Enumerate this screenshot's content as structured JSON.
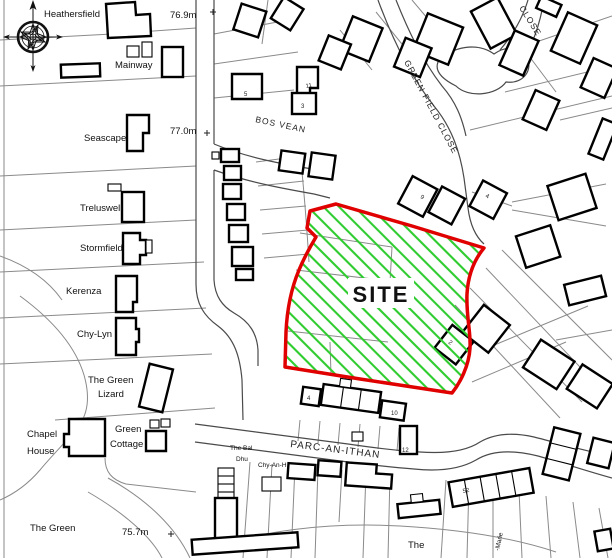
{
  "site": {
    "label": "SITE",
    "boundary_color": "#e00000",
    "hatch_color": "#2ecc2e"
  },
  "place_labels": [
    {
      "text": "Heathersfield"
    },
    {
      "text": "Mainway"
    },
    {
      "text": "Seascape"
    },
    {
      "text": "Treluswell"
    },
    {
      "text": "Stormfield"
    },
    {
      "text": "Kerenza"
    },
    {
      "text": "Chy-Lyn"
    },
    {
      "text": "The Green"
    },
    {
      "text": "Lizard"
    },
    {
      "text": "Chapel"
    },
    {
      "text": "House"
    },
    {
      "text": "Green"
    },
    {
      "text": "Cottage"
    },
    {
      "text": "The Green"
    },
    {
      "text": "The"
    },
    {
      "text": "The Bal"
    },
    {
      "text": "Dhu"
    },
    {
      "text": "Chy-An-H"
    },
    {
      "text": "-Marie"
    }
  ],
  "road_labels": [
    {
      "text": "BOS VEAN"
    },
    {
      "text": "GREEN FIELD CLOSE"
    },
    {
      "text": "CLOSE"
    },
    {
      "text": "PARC-AN-ITHAN"
    }
  ],
  "spot_heights": [
    {
      "text": "76.9m"
    },
    {
      "text": "77.0m"
    },
    {
      "text": "75.7m"
    }
  ],
  "house_numbers": [
    {
      "text": "5"
    },
    {
      "text": "11"
    },
    {
      "text": "3"
    },
    {
      "text": "9"
    },
    {
      "text": "4"
    },
    {
      "text": "4"
    },
    {
      "text": "10"
    },
    {
      "text": "12"
    },
    {
      "text": "52"
    },
    {
      "text": "2"
    }
  ]
}
